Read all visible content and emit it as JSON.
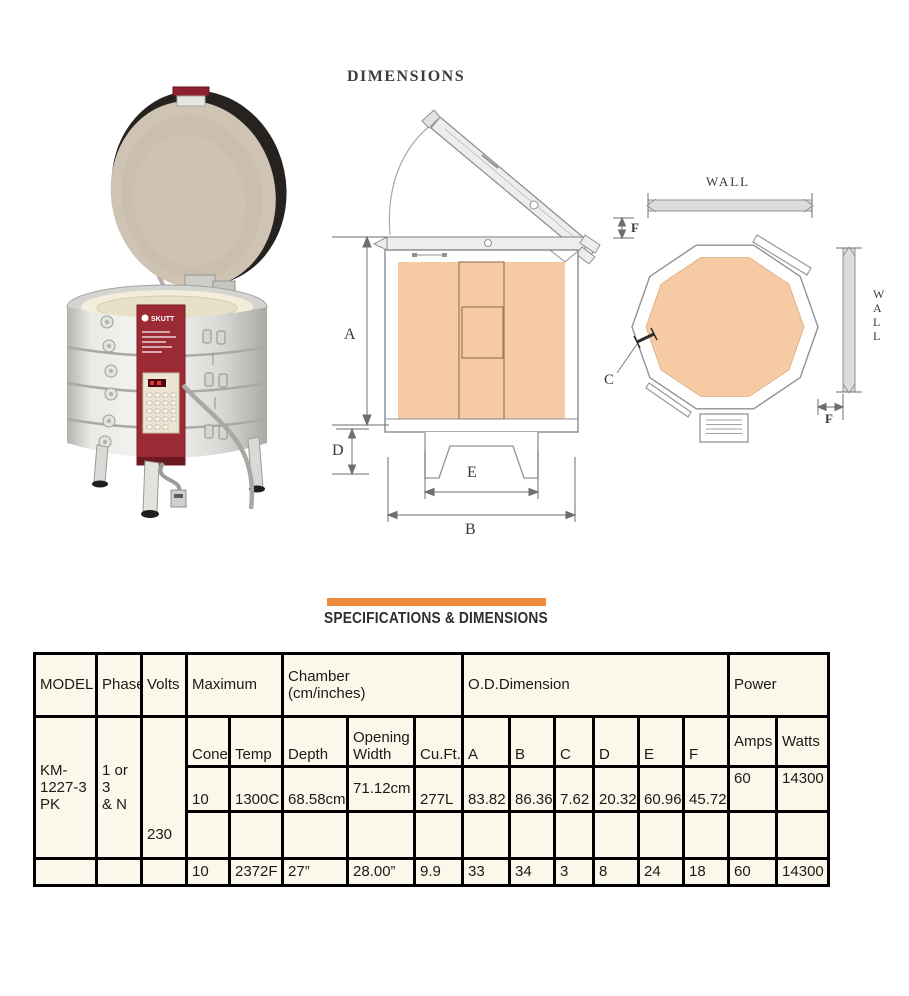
{
  "headings": {
    "dimensions": "DIMENSIONS",
    "specifications": "SPECIFICATIONS & DIMENSIONS"
  },
  "colors": {
    "accent_orange": "#EF8A3B",
    "diagram_peach": "#F6CBA3",
    "kiln_red": "#9C2A34",
    "table_background": "#FBF8EB"
  },
  "photo": {
    "brand": "SKUTT"
  },
  "side_view": {
    "label_a": "A",
    "label_b": "B",
    "label_d": "D",
    "label_e": "E"
  },
  "top_view": {
    "wall_top": "WALL",
    "wall_right": "W\nA\nL\nL",
    "label_f_top": "F",
    "label_f_bottom": "F",
    "label_c": "C"
  },
  "table": {
    "header1": {
      "model": "MODEL",
      "phase": "Phase",
      "volts": "Volts",
      "maximum": "Maximum",
      "chamber": "Chamber\n(cm/inches)",
      "od_dimension": "O.D.Dimension",
      "power": "Power"
    },
    "header2": {
      "cone": "Cone",
      "temp": "Temp",
      "depth": "Depth",
      "opening_width": "Opening\nWidth",
      "cu_ft": "Cu.Ft.",
      "a": "A",
      "b": "B",
      "c": "C",
      "d": "D",
      "e": "E",
      "f": "F",
      "amps": "Amps",
      "watts": "Watts"
    },
    "model_value": "KM-\n1227-3\nPK",
    "phase_value": "1 or 3\n& N",
    "volts_value": "230",
    "metric_row": [
      "10",
      "1300C",
      "68.58cm",
      "71.12cm",
      "277L",
      "83.82",
      "86.36",
      "7.62",
      "20.32",
      "60.96",
      "45.72",
      "60",
      "14300"
    ],
    "imperial_row": [
      "10",
      "2372F",
      "27”",
      "28.00”",
      "9.9",
      "33",
      "34",
      "3",
      "8",
      "24",
      "18",
      "60",
      "14300"
    ]
  }
}
